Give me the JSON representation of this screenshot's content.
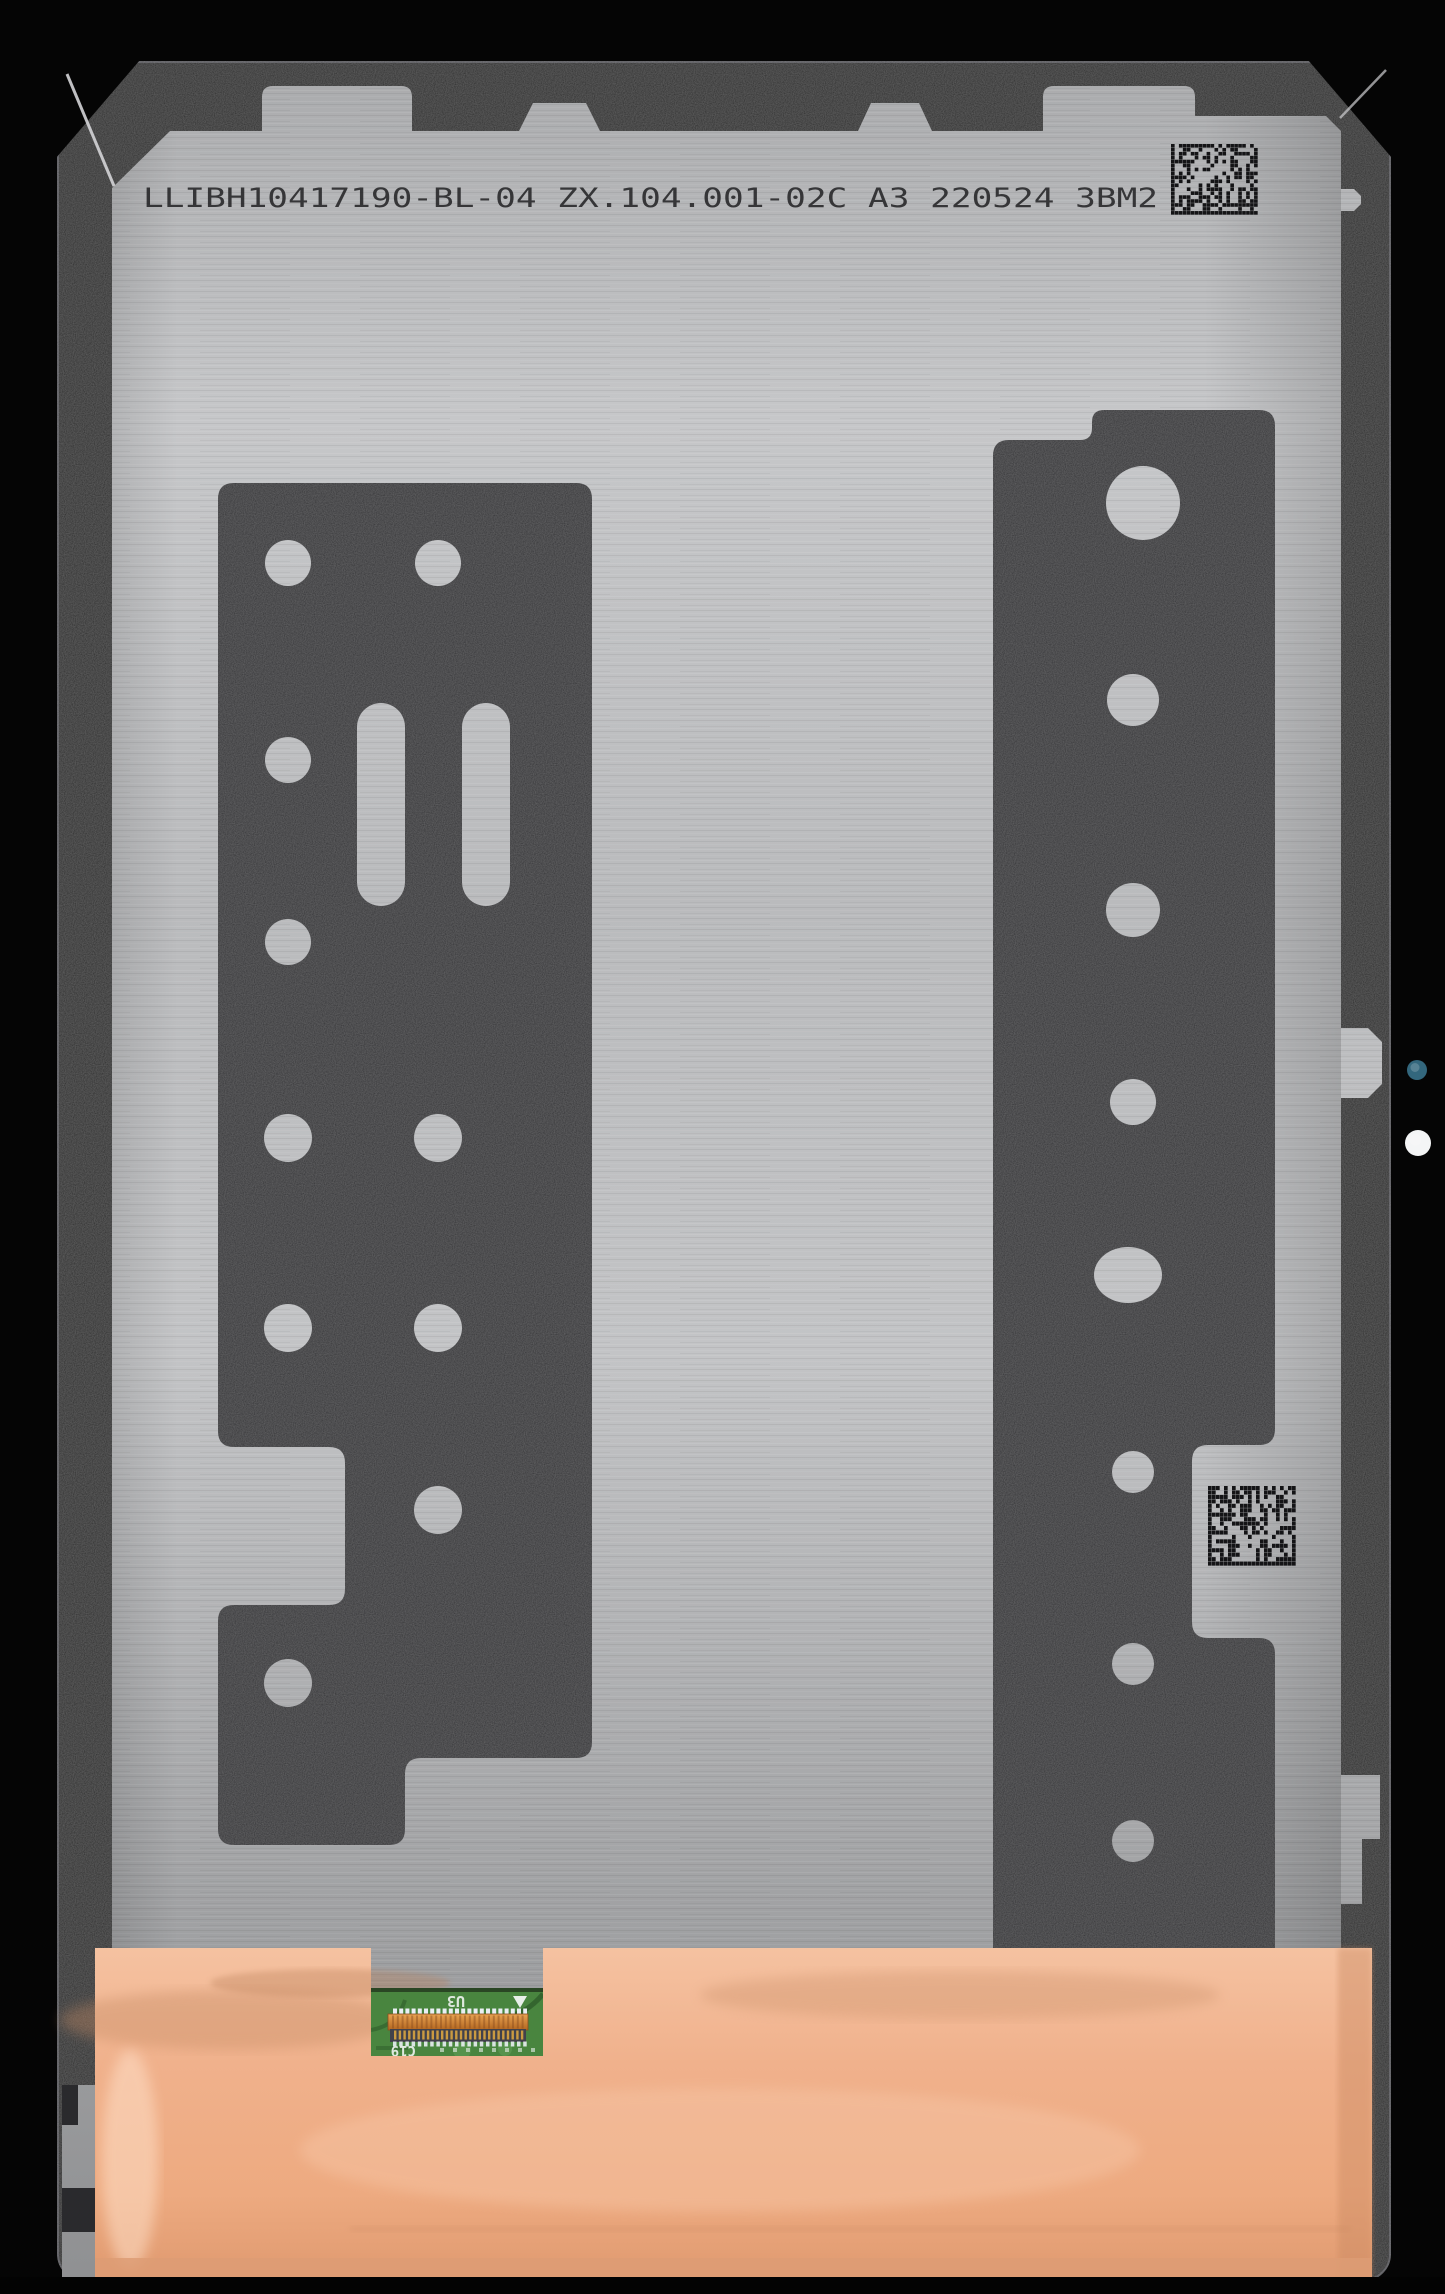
{
  "photo": {
    "subject": "tablet-lcd-display-assembly-back",
    "etched_text": {
      "full_line": "LLIBH10417190-BL-04 ZX.104.001-02C A3 220524 3BM2",
      "serial": "LLIBH10417190-BL-04",
      "part_number": "ZX.104.001-02C",
      "revision": "A3",
      "date_code": "220524",
      "batch": "3BM2"
    },
    "pcb_silkscreen": {
      "u3": "U3",
      "c19": "C19"
    }
  },
  "colors": {
    "background_black": "#050505",
    "bezel_band": "#29292c",
    "bezel_edge_highlight": "#57575b",
    "panel_silver_light": "#c9cacc",
    "panel_silver_dark": "#97989a",
    "adhesive_strip": "#313134",
    "etched_ink": "#1e1e20",
    "copper_foil": "#f0b18c",
    "copper_shadow": "#cf9168",
    "pcb_green": "#49853f",
    "connector_orange": "#d88f3e",
    "connector_base_gray": "#41414b",
    "gold_pins": "#d9a441",
    "blue_dot": "#33677d",
    "white_dot": "#f4f5f6"
  },
  "geometry": {
    "left_strip_holes": [
      {
        "cx": 288,
        "cy": 563,
        "r": 23
      },
      {
        "cx": 438,
        "cy": 563,
        "r": 23
      },
      {
        "cx": 288,
        "cy": 760,
        "r": 23
      },
      {
        "cx": 288,
        "cy": 942,
        "r": 23
      },
      {
        "cx": 288,
        "cy": 1138,
        "r": 24
      },
      {
        "cx": 438,
        "cy": 1138,
        "r": 24
      },
      {
        "cx": 288,
        "cy": 1328,
        "r": 24
      },
      {
        "cx": 438,
        "cy": 1328,
        "r": 24
      },
      {
        "cx": 438,
        "cy": 1510,
        "r": 24
      },
      {
        "cx": 288,
        "cy": 1683,
        "r": 24
      }
    ],
    "left_strip_slots": [
      {
        "x": 357,
        "y": 703,
        "w": 48,
        "h": 203
      },
      {
        "x": 462,
        "y": 703,
        "w": 48,
        "h": 203
      }
    ],
    "right_strip_holes": [
      {
        "cx": 1143,
        "cy": 503,
        "r": 37
      },
      {
        "cx": 1133,
        "cy": 700,
        "r": 26
      },
      {
        "cx": 1133,
        "cy": 910,
        "r": 27
      },
      {
        "cx": 1133,
        "cy": 1102,
        "r": 23
      },
      {
        "cx": 1128,
        "cy": 1275,
        "r": 34,
        "ry": 28
      },
      {
        "cx": 1133,
        "cy": 1472,
        "r": 21
      },
      {
        "cx": 1133,
        "cy": 1664,
        "r": 21
      },
      {
        "cx": 1133,
        "cy": 1841,
        "r": 21
      }
    ],
    "datamatrix_codes": [
      {
        "x": 1171,
        "y": 144,
        "w": 87,
        "h": 71,
        "cols": 22,
        "rows": 18,
        "seed": 11
      },
      {
        "x": 1208,
        "y": 1486,
        "w": 88,
        "h": 80,
        "cols": 22,
        "rows": 18,
        "seed": 29
      }
    ],
    "bezel_dots": [
      {
        "cx": 1417,
        "cy": 1070,
        "r": 10,
        "colorKey": "blue_dot",
        "name": "blue-camera-dot"
      },
      {
        "cx": 1418,
        "cy": 1143,
        "r": 13,
        "colorKey": "white_dot",
        "name": "white-sensor-dot"
      }
    ]
  }
}
